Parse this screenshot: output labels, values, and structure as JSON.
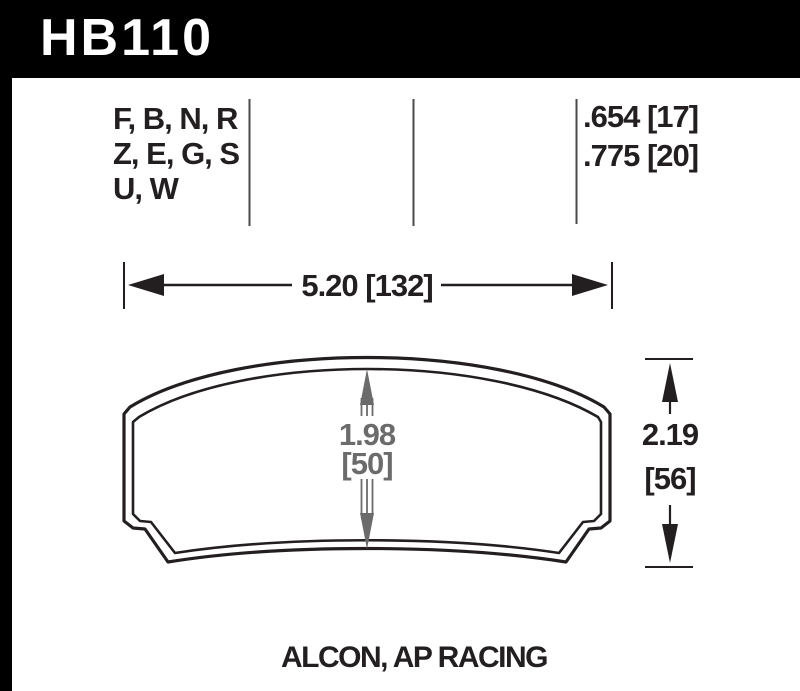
{
  "header": {
    "part_number": "HB110"
  },
  "spec": {
    "compounds": [
      "F, B, N, R",
      "Z, E, G, S",
      "U, W"
    ],
    "pad_thickness": [
      ".654 [17]",
      ".775 [20]"
    ]
  },
  "dimensions": {
    "width": "5.20 [132]",
    "height": {
      "in": "2.19",
      "mm": "[56]"
    },
    "center": {
      "in": "1.98",
      "mm": "[50]"
    }
  },
  "footer": {
    "applications": "ALCON, AP RACING"
  },
  "colors": {
    "header_bg": "#000000",
    "text": "#231f20",
    "dim_gray": "#6b6b6b"
  }
}
